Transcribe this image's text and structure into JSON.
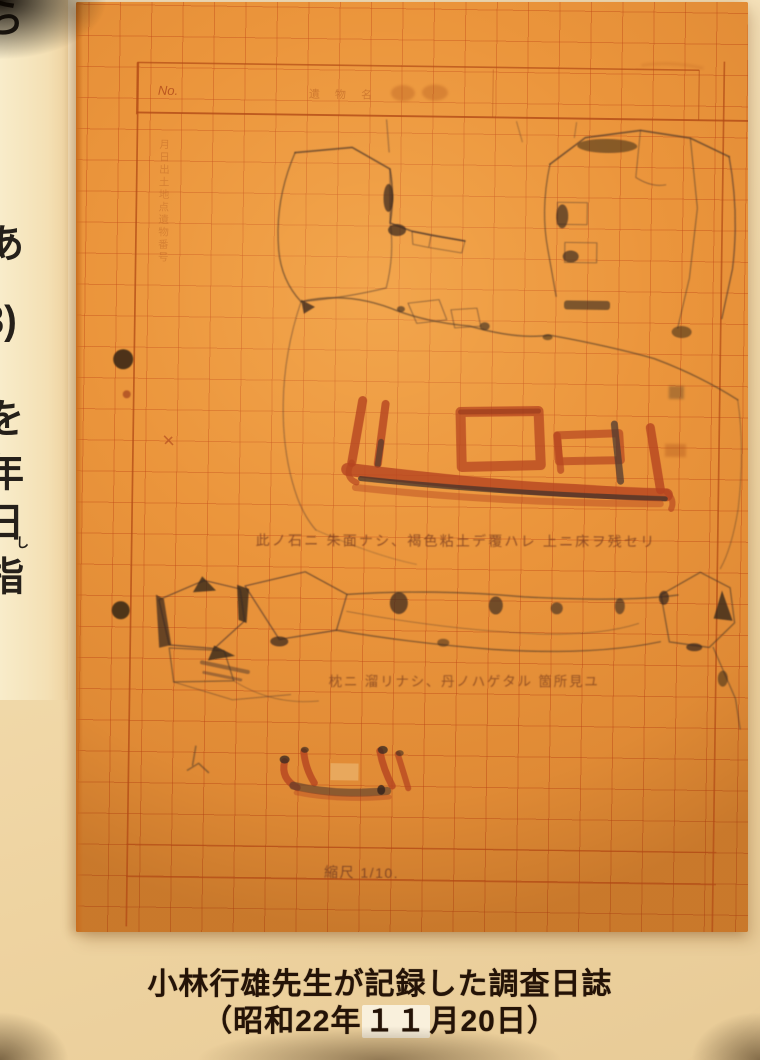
{
  "poster": {
    "left_column_chars": [
      "ら",
      "あ",
      "3)",
      "を",
      "年",
      "日"
    ],
    "left_column_ruby_furigana": "し",
    "left_column_ruby_char": "指"
  },
  "sheet": {
    "no_label": "No.",
    "header_printed_faint": "遺 物 名",
    "left_margin_printed_faint": "月日出土地点遺物番号",
    "handwritten_note_1": "此ノ石ニ 朱面ナシ、褐色粘土デ覆ハレ 上ニ床ヲ残セリ",
    "handwritten_note_2": "枕ニ 溜リナシ、丹ノハゲタル 箇所見ユ",
    "scale_note": "縮尺 1/10.",
    "paper_color": "#e8923a",
    "grid_color": "#c05a1f",
    "red_ink_color": "#b5441f",
    "pencil_color": "#4f382a"
  },
  "caption": {
    "line1": "小林行雄先生が記録した調査日誌",
    "line2_prefix": "（昭和22年",
    "line2_patch": "１１",
    "line2_suffix": "月20日）",
    "ink_color": "#241307"
  }
}
